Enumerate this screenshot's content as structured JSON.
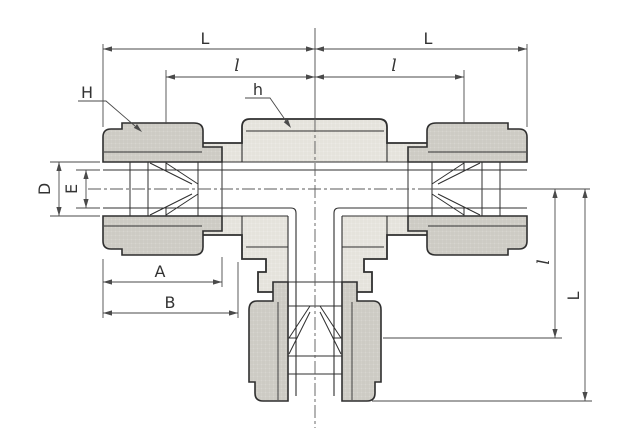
{
  "drawing": {
    "labels": {
      "top_left_L": "L",
      "top_left_l": "l",
      "top_right_L": "L",
      "top_right_l": "l",
      "nut_hex_H": "H",
      "body_hex_h": "h",
      "tube_od_D": "D",
      "bore_E": "E",
      "nut_length_A": "A",
      "body_length_B": "B",
      "branch_l": "l",
      "branch_L": "L"
    },
    "colors": {
      "outline": "#2f2f2f",
      "dimension": "#4a4a4a",
      "label": "#333333",
      "body_fill": "#eceae5",
      "nut_fill": "#d7d5cf",
      "background": "#ffffff"
    }
  }
}
